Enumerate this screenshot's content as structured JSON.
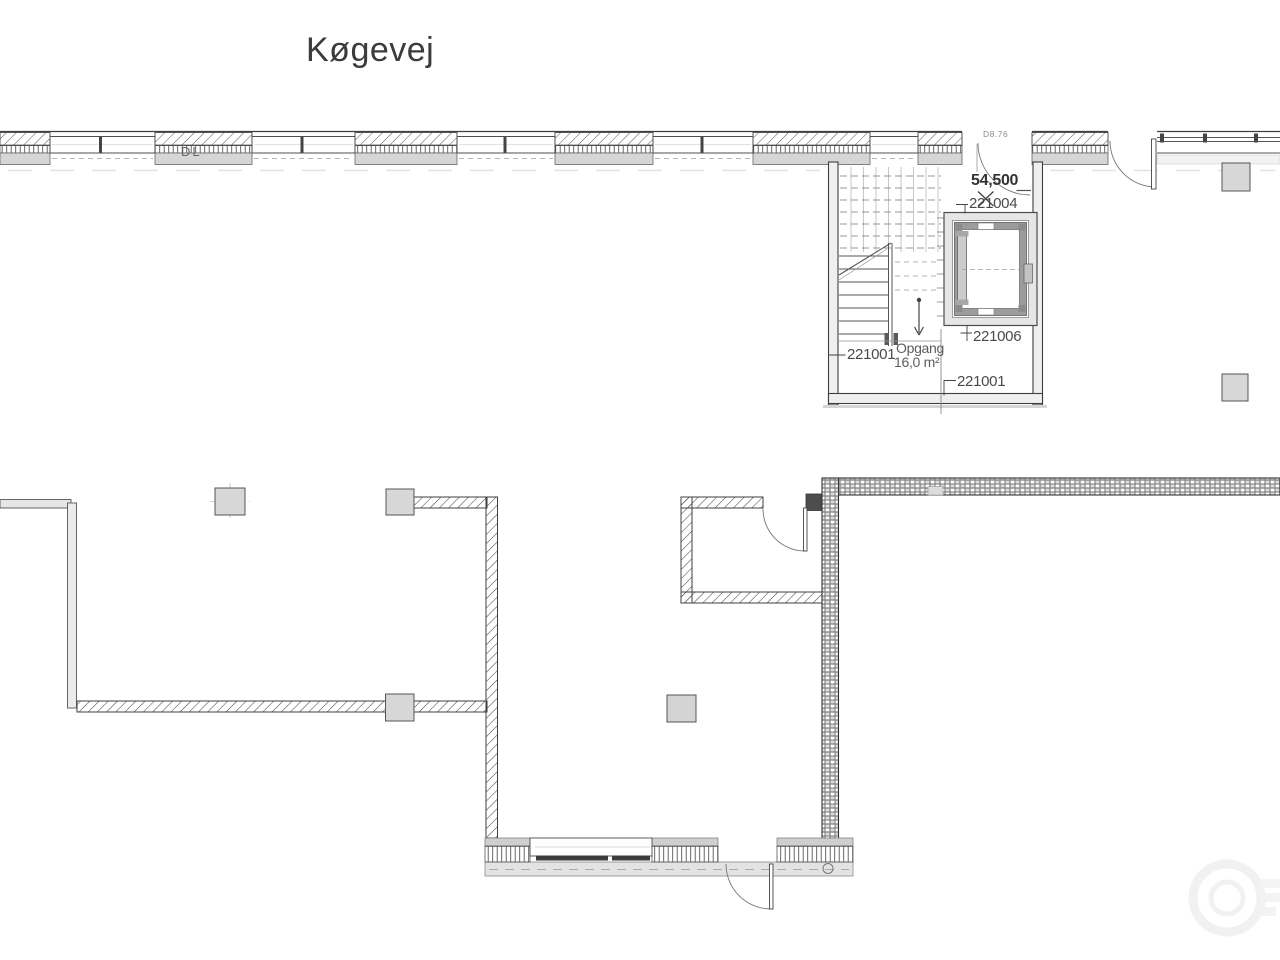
{
  "street_label": "Køgevej",
  "facade": {
    "dl_label": "DL",
    "door_tag": "D8.76"
  },
  "stairwell": {
    "level_mark": "54,500",
    "name": "Opgang",
    "area": "16,0 m²",
    "room_ids": {
      "elevator": "221004",
      "shaft_lower": "221006",
      "left": "221001",
      "bottom": "221001"
    }
  },
  "colors": {
    "line": "#3f3f3f",
    "wall_fill": "#ececec",
    "column_fill": "#d7d7d7",
    "sill_band": "#d6d6d6",
    "outer_band": "#e3e3e3",
    "text": "#4a4a4a"
  }
}
